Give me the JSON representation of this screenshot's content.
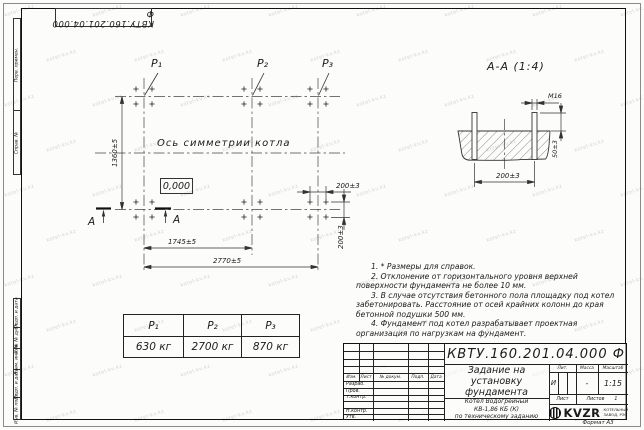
{
  "watermark": {
    "text": "kotel-kv.kz"
  },
  "corner_stamp": {
    "designation": "КВТУ.160.201.04.000 Ф"
  },
  "side_stamps": {
    "perv_primen": "Перв. примен.",
    "sprav_n": "Справ. №",
    "podp_data_1": "Подп. и дата",
    "inv_dubl": "Инв. № дубл.",
    "vzam_inv": "Взам. инв. №",
    "podp_data_2": "Подп. и дата",
    "inv_podl": "Инв. № подл."
  },
  "plan": {
    "p1_label": "P₁",
    "p2_label": "P₂",
    "p3_label": "P₃",
    "axis_label": "Ось симметрии котла",
    "zero_mark": "0,000",
    "dim_height": "1360±5",
    "dim_width_inner": "1745±5",
    "dim_width_outer": "2770±5",
    "dim_bolt_spacing_h": "200±3",
    "dim_bolt_spacing_v": "200±3",
    "section_letter_left": "А",
    "section_letter_right": "А"
  },
  "section": {
    "title": "А-А (1:4)",
    "bolt_thread": "М16",
    "dim_protrusion": "50±3",
    "dim_spacing": "200±3"
  },
  "notes": {
    "items": [
      "1. * Размеры для справок.",
      "2. Отклонение от горизонтального уровня верхней поверхности фундамента не более 10 мм.",
      "3. В случае отсутствия бетонного пола площадку под котел забетонировать. Расстояние от осей крайних колонн до края бетонной подушки 500 мм.",
      "4. Фундамент под котел разрабатывает проектная организация по нагрузкам на фундамент."
    ]
  },
  "load_table": {
    "headers": [
      "P₁",
      "P₂",
      "P₃"
    ],
    "values": [
      "630 кг",
      "2700 кг",
      "870 кг"
    ]
  },
  "title_block": {
    "designation": "КВТУ.160.201.04.000 Ф",
    "doc_title": [
      "Задание на",
      "установку",
      "фундамента"
    ],
    "product": [
      "Котел Водогрейный",
      "КВ-1,86 КБ (К)",
      "по техническому заданию"
    ],
    "header_cols": [
      "Изм.",
      "Лист",
      "№ докум.",
      "Подп.",
      "Дата"
    ],
    "rows": {
      "razrab": "Разраб.",
      "prov": "Пров.",
      "tkontr": "Т.контр.",
      "nkontr": "Н.контр.",
      "utv": "Утв."
    },
    "lit_label": "Лит.",
    "lit_value": "И",
    "massa_label": "Масса",
    "massa_value": "-",
    "scale_label": "Масштаб",
    "scale_value": "1:15",
    "sheet_label": "Лист",
    "sheets_label": "Листов",
    "sheets_value": "1",
    "logo_text": "KVZR",
    "logo_caption": [
      "КОТЕЛЬНЫЙ",
      "ЗАВОД, РЭП"
    ],
    "format_note": "Формат А3"
  }
}
